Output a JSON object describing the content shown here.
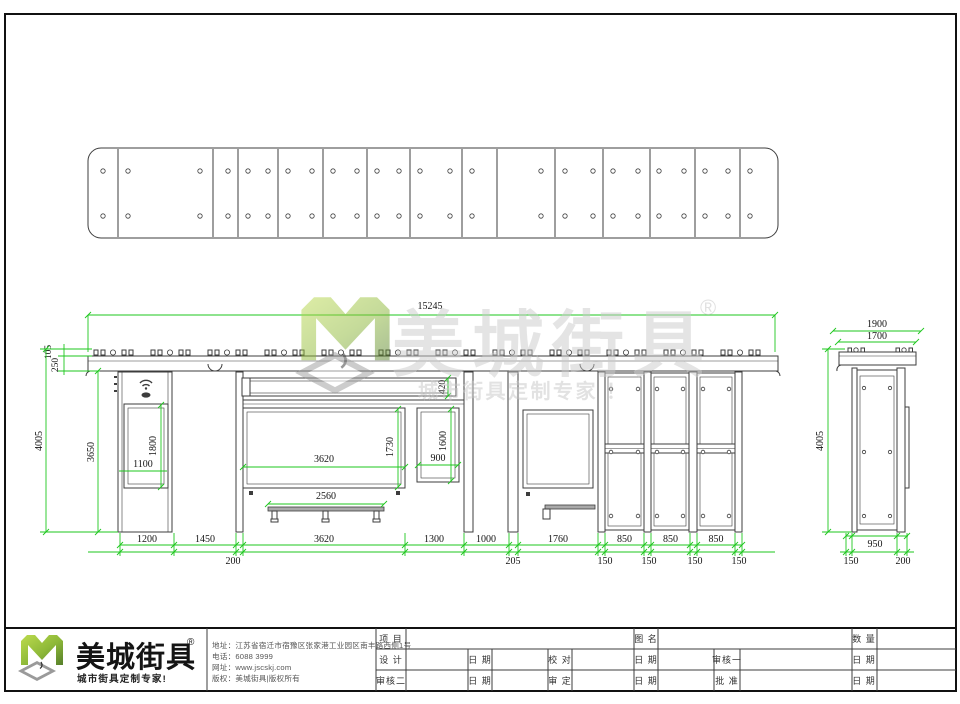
{
  "watermark": {
    "brand": "美城街具",
    "reg": "®",
    "tagline": "城市街具定制专家 ！"
  },
  "front": {
    "total_width": "15245",
    "roof_trim_h": "105",
    "fascia_h": "250",
    "total_height": "4005",
    "body_height": "3650",
    "left_screen_h": "1800",
    "left_screen_w": "1100",
    "lightbox_h": "420",
    "board_w": "3620",
    "board_h": "1730",
    "bench_w": "2560",
    "right_screen_w": "900",
    "right_screen_h": "1600",
    "bottom_dims": [
      "1200",
      "1450",
      "3620",
      "1300",
      "1000",
      "1760",
      "850",
      "850",
      "850"
    ],
    "post_dims": [
      "200",
      "205",
      "150",
      "150",
      "150",
      "150"
    ]
  },
  "side": {
    "roof_w": "1900",
    "canopy_w": "1700",
    "total_height": "4005",
    "base_w": "950",
    "offset_left": "150",
    "offset_right": "200"
  },
  "footer": {
    "brand": "美城街具",
    "reg": "®",
    "tagline": "城市街具定制专家!",
    "company": {
      "address": "地址：江苏省宿迁市宿豫区张家港工业园区南丰路西侧1号",
      "phone": "电话：6088 3999",
      "website": "网址：www.jscskj.com",
      "copyright": "版权：美城街具|版权所有"
    },
    "titleblock": {
      "project": "项 目",
      "drawing_name": "图 名",
      "quantity": "数 量",
      "design": "设 计",
      "proofread": "校 对",
      "review1": "审核一",
      "review2": "审核二",
      "approve": "审 定",
      "ratify": "批 准",
      "date": "日 期"
    }
  }
}
